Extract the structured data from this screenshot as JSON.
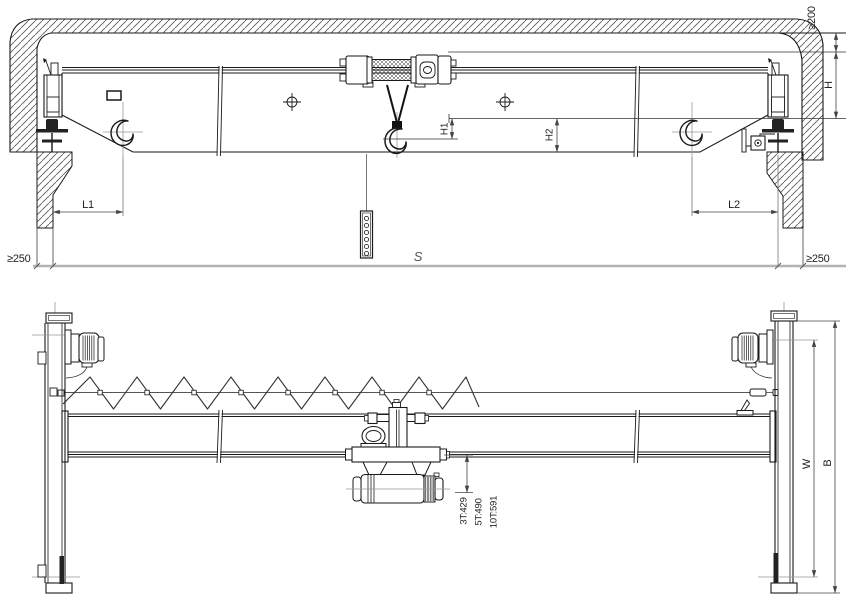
{
  "labels": {
    "top_clearance": "≥200",
    "crane_height": "H",
    "hook_dim_h1": "H1",
    "hook_dim_h2": "H2",
    "left_hook_approach": "L1",
    "right_hook_approach": "L2",
    "span": "S",
    "left_side_clearance": "≥250",
    "right_side_clearance": "≥250",
    "hook_offset_3t": "3T:429",
    "hook_offset_5t": "5T:490",
    "hook_offset_10t": "10T:591",
    "wheelbase": "W",
    "end_carriage_length": "B"
  },
  "colors": {
    "line": "#1a1a1a",
    "dimension": "#444444",
    "centerline": "#999999",
    "baseline": "#b3b3b3",
    "background": "#ffffff"
  }
}
